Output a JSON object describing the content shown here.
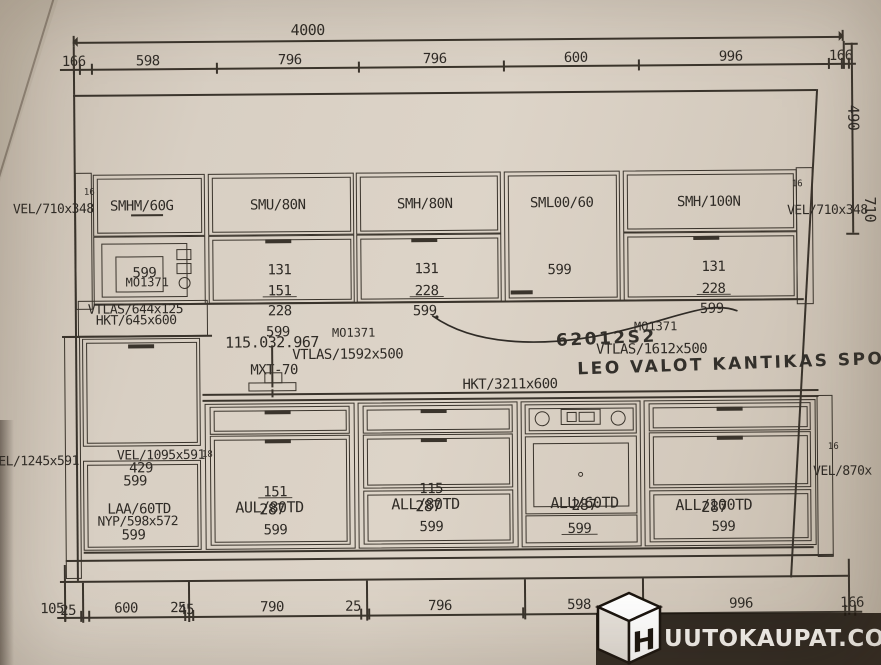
{
  "dims": {
    "top_total": "4000",
    "top_segments": [
      "166",
      "598",
      "796",
      "796",
      "600",
      "996",
      "166"
    ],
    "right_height": "490",
    "right_depth": "710",
    "bottom_labels": [
      "105",
      "25",
      "600",
      "25",
      "45",
      "790",
      "25",
      "796",
      "598",
      "996",
      "166"
    ]
  },
  "panels": {
    "left_upper": "VEL/710x348",
    "right_upper": "VEL/710x348",
    "left_tall": "VEL/1245x591",
    "right_lower": "VEL/870x",
    "tall_front": "VEL/1095x591"
  },
  "upper": {
    "smhm_code": "SMHM/60G",
    "mw_num": "599",
    "mw_code": "MO1371",
    "smu_code": "SMU/80N",
    "smu_nums": [
      "131",
      "151",
      "228",
      "599"
    ],
    "smh80_code": "SMH/80N",
    "smh80_nums": [
      "131",
      "228",
      "599"
    ],
    "sml_code": "SML00/60",
    "sml_num": "599",
    "smh100_code": "SMH/100N",
    "smh100_nums": [
      "131",
      "228",
      "599"
    ]
  },
  "mid": {
    "vtlas_hood": "VTLAS/644x125",
    "hkt_hood": "HKT/645x600",
    "ref_no": "115.032.967",
    "mo_mid": "MO1371",
    "vtlas_left": "VTLAS/1592x500",
    "faucet": "MXT-70",
    "hkt_top": "HKT/3211x600",
    "mo_right": "MO1371",
    "vtlas_right": "VTLAS/1612x500"
  },
  "handwriting": {
    "code": "62012S2",
    "note": "LEO VALOT KANTIKAS SPOTIT"
  },
  "lower": {
    "tall_nums": [
      "429",
      "599"
    ],
    "laa_code": "LAA/60TD",
    "nyp_code": "NYP/598x572",
    "laa_num": "599",
    "aul_code": "AUL/80TD",
    "aul_nums": [
      "151",
      "287",
      "599"
    ],
    "all80_code": "ALL/80TD",
    "all80_nums": [
      "115",
      "287",
      "599"
    ],
    "alu_code": "ALU/60TD",
    "alu_nums": [
      "287",
      "599"
    ],
    "all100_code": "ALL/100TD",
    "all100_nums": [
      "287",
      "599"
    ]
  },
  "markers": {
    "edge16": "16",
    "edge18": "18"
  },
  "watermark": {
    "letter": "H",
    "text": "UUTOKAUPAT.COM"
  }
}
